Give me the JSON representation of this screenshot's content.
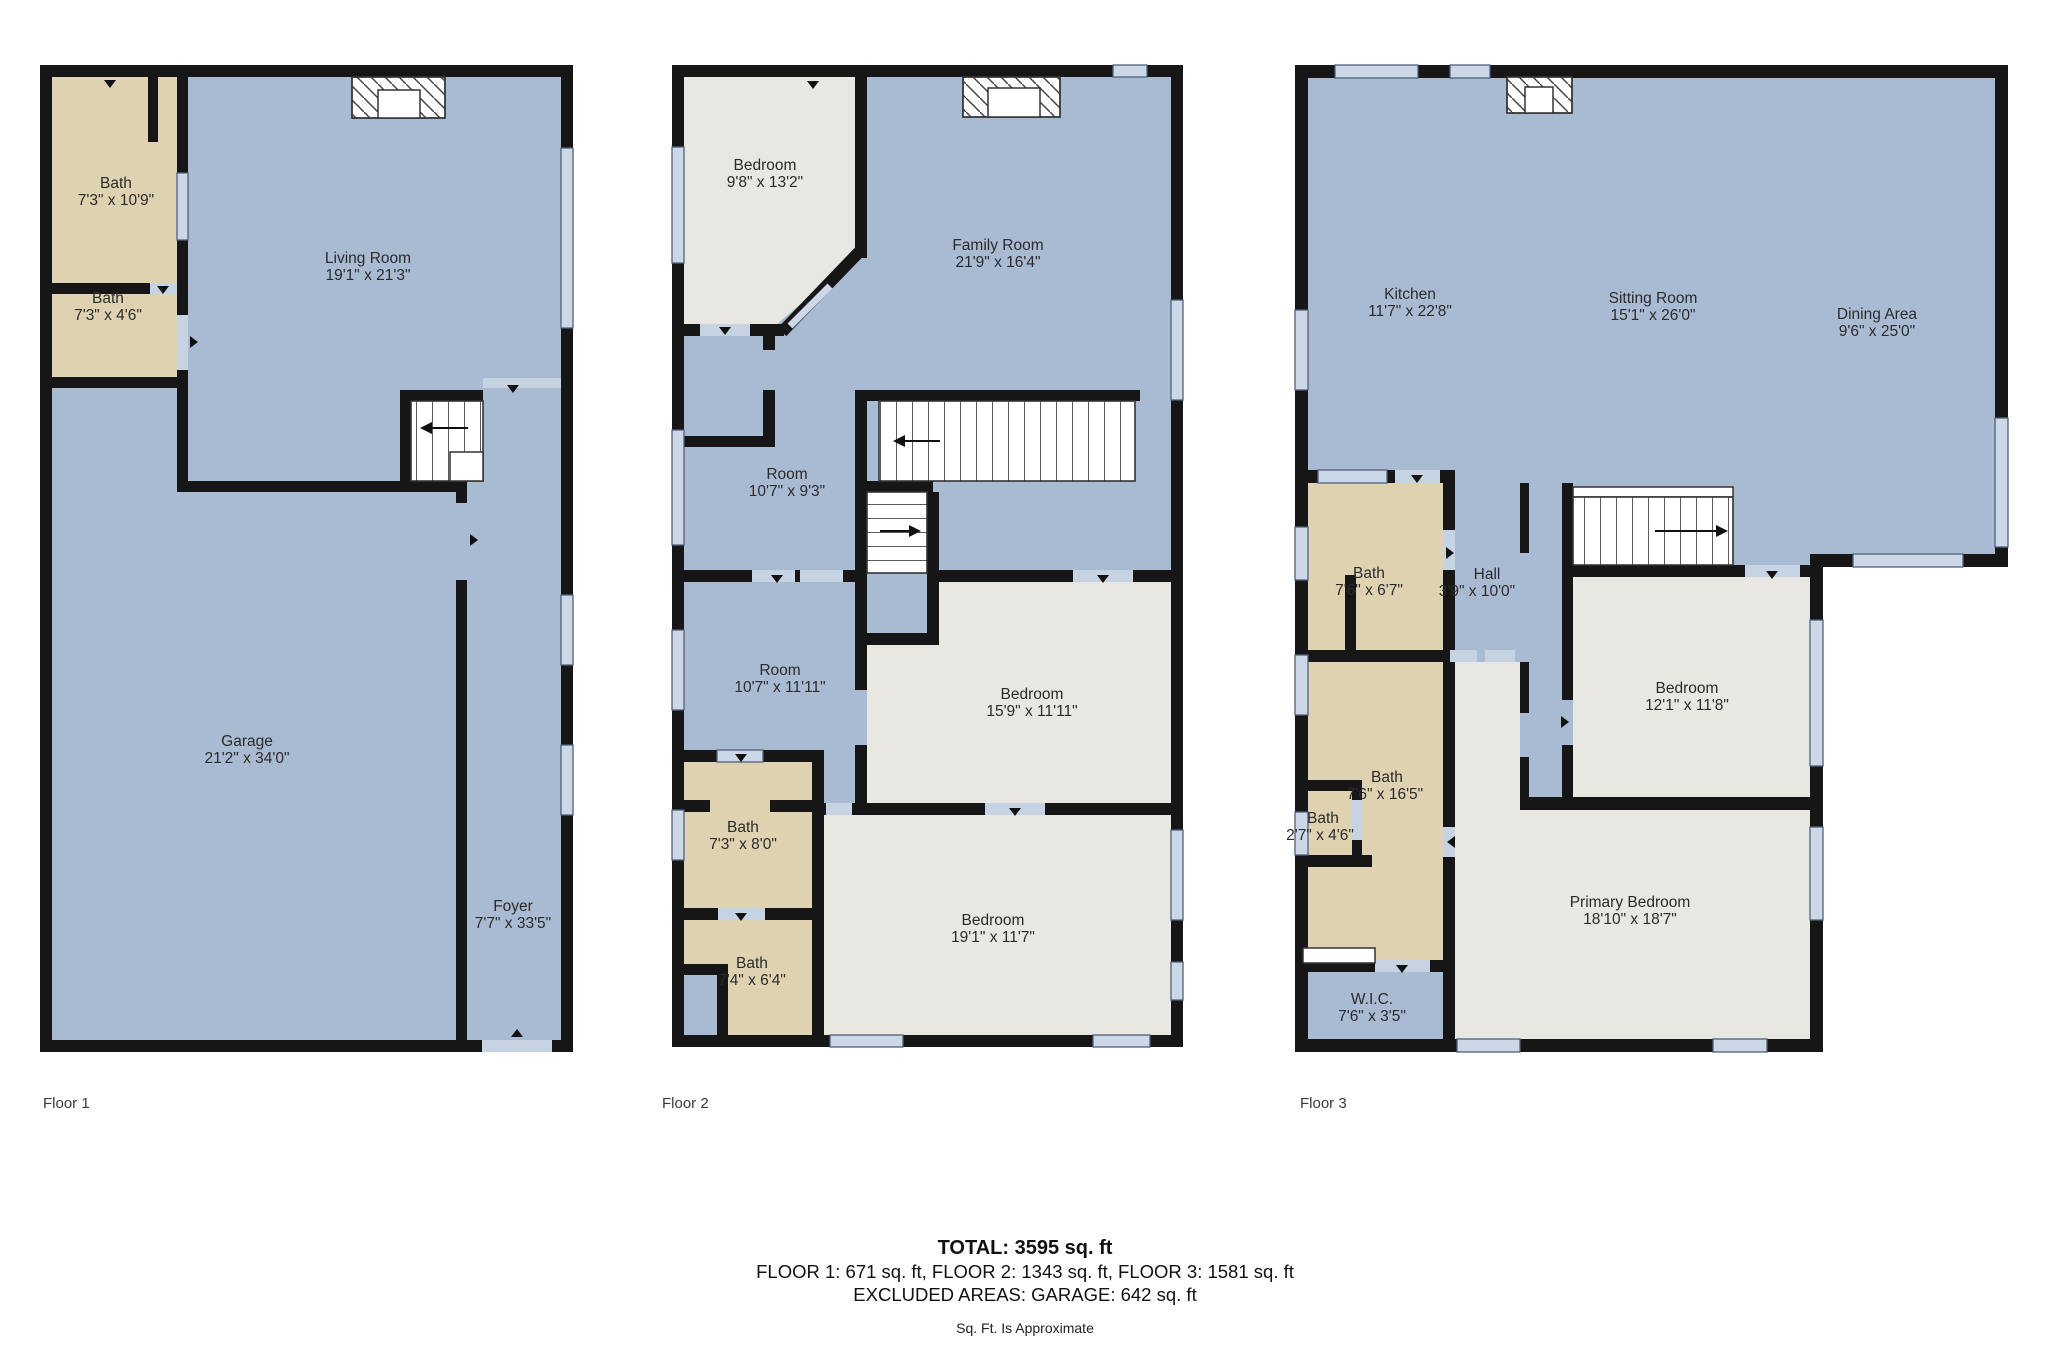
{
  "colors": {
    "wall": "#161616",
    "room_blue": "#a9bbd3",
    "room_tan": "#ded2b0",
    "room_gray": "#e9e7e2",
    "window": "#ccd8e7",
    "text": "#2b2b2b"
  },
  "floors": [
    {
      "label": "Floor 1",
      "rooms": [
        {
          "name": "Bath",
          "dims": "7'3\" x 10'9\""
        },
        {
          "name": "Bath",
          "dims": "7'3\" x 4'6\""
        },
        {
          "name": "Living Room",
          "dims": "19'1\" x 21'3\""
        },
        {
          "name": "Garage",
          "dims": "21'2\" x 34'0\""
        },
        {
          "name": "Foyer",
          "dims": "7'7\" x 33'5\""
        }
      ]
    },
    {
      "label": "Floor 2",
      "rooms": [
        {
          "name": "Bedroom",
          "dims": "9'8\" x 13'2\""
        },
        {
          "name": "Family Room",
          "dims": "21'9\" x 16'4\""
        },
        {
          "name": "Room",
          "dims": "10'7\" x 9'3\""
        },
        {
          "name": "Room",
          "dims": "10'7\" x 11'11\""
        },
        {
          "name": "Bedroom",
          "dims": "15'9\" x 11'11\""
        },
        {
          "name": "Bath",
          "dims": "7'3\" x 8'0\""
        },
        {
          "name": "Bath",
          "dims": "7'4\" x 6'4\""
        },
        {
          "name": "Bedroom",
          "dims": "19'1\" x 11'7\""
        }
      ]
    },
    {
      "label": "Floor 3",
      "rooms": [
        {
          "name": "Kitchen",
          "dims": "11'7\" x 22'8\""
        },
        {
          "name": "Sitting Room",
          "dims": "15'1\" x 26'0\""
        },
        {
          "name": "Dining Area",
          "dims": "9'6\" x 25'0\""
        },
        {
          "name": "Bath",
          "dims": "7'6\" x 6'7\""
        },
        {
          "name": "Hall",
          "dims": "3'9\" x 10'0\""
        },
        {
          "name": "Bedroom",
          "dims": "12'1\" x 11'8\""
        },
        {
          "name": "Bath",
          "dims": "7'6\" x 16'5\""
        },
        {
          "name": "Bath",
          "dims": "2'7\" x 4'6\""
        },
        {
          "name": "Primary Bedroom",
          "dims": "18'10\" x 18'7\""
        },
        {
          "name": "W.I.C.",
          "dims": "7'6\" x 3'5\""
        }
      ]
    }
  ],
  "summary": {
    "total": "TOTAL: 3595 sq. ft",
    "floors_line": "FLOOR 1: 671 sq. ft, FLOOR 2: 1343 sq. ft, FLOOR 3: 1581 sq. ft",
    "excluded_line": "EXCLUDED AREAS: GARAGE: 642 sq. ft",
    "disclaimer": "Sq. Ft. Is Approximate"
  }
}
